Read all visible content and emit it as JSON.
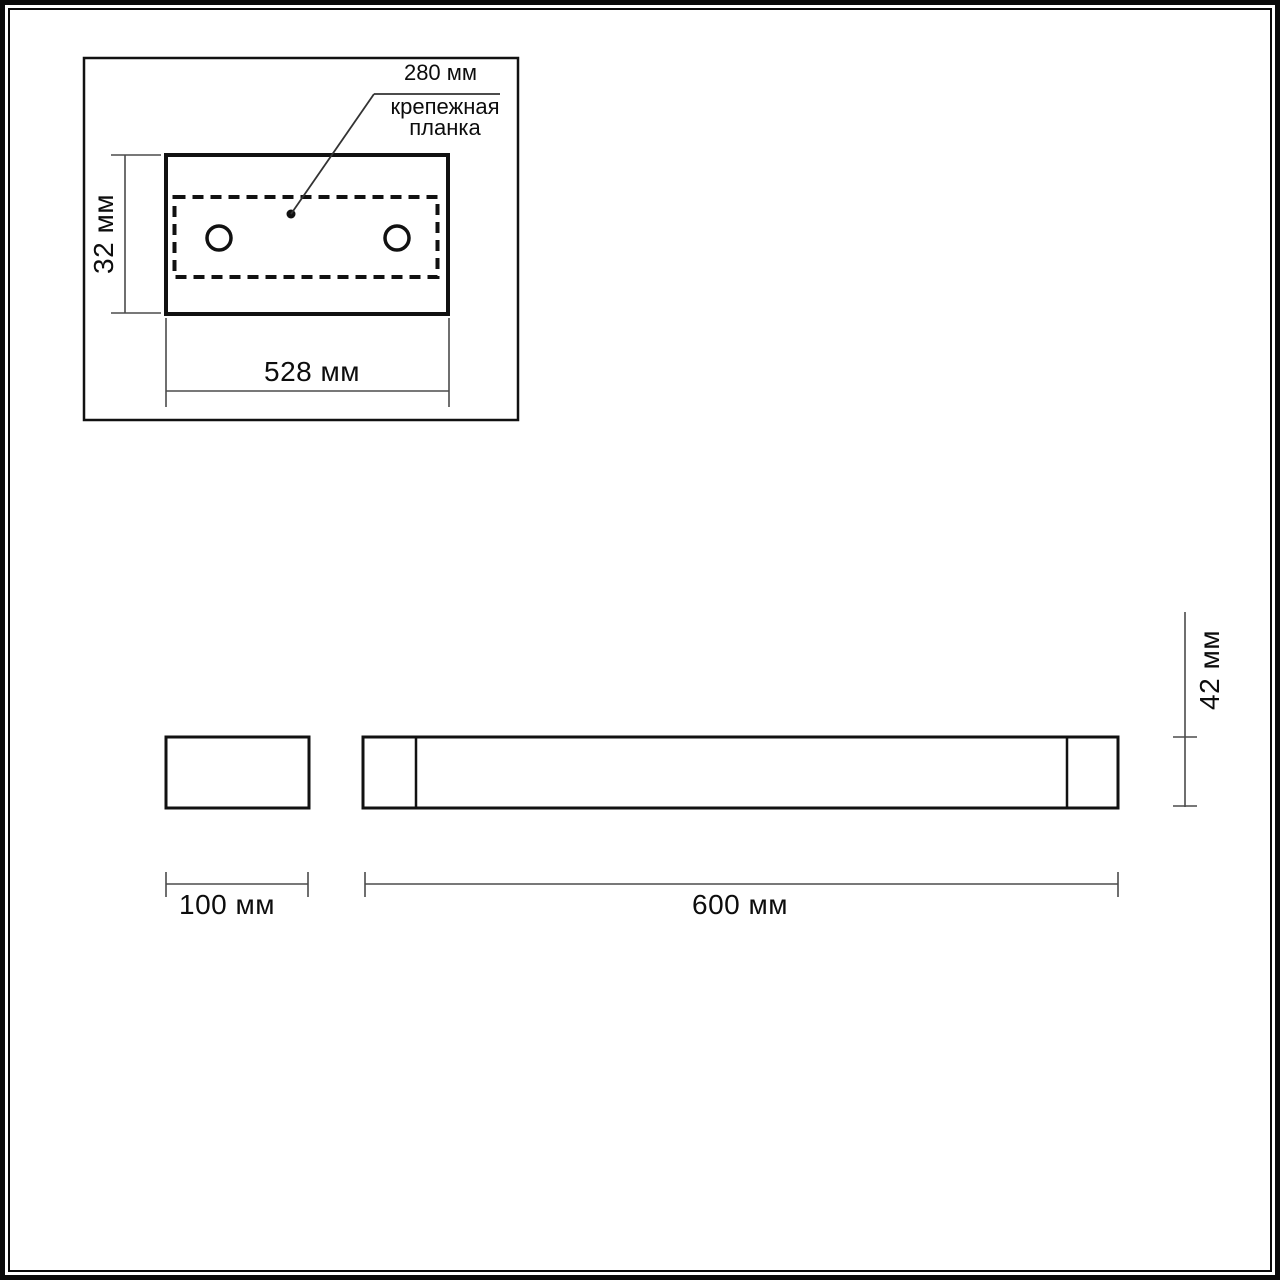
{
  "colors": {
    "outline": "#111111",
    "dimension_line": "#4b4b4b",
    "background": "#ffffff"
  },
  "views": {
    "back_view": {
      "mounting_span_label": "280 мм",
      "mounting_caption": "крепежная\nпланка",
      "height_label": "32 мм",
      "width_label": "528 мм"
    },
    "side_view": {
      "width_label": "100 мм"
    },
    "front_view": {
      "width_label": "600 мм",
      "height_label": "42 мм"
    }
  }
}
